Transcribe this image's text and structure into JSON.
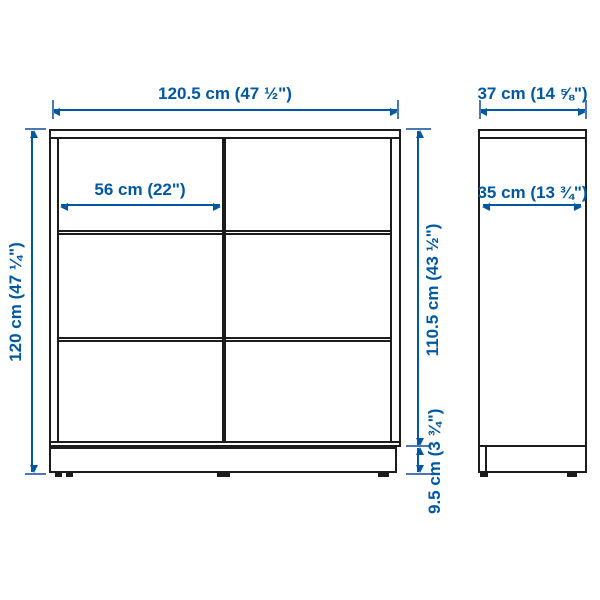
{
  "diagram_title": "Shelving unit dimension diagram",
  "colors": {
    "dimension_blue": "#0058a3",
    "tick_blue": "#4a78b5",
    "outline_dark": "#1c1c1c",
    "background": "#ffffff"
  },
  "front_view": {
    "width_label": "120.5 cm (47 ½\")",
    "inner_width_label": "56 cm (22\")",
    "height_label": "120 cm (47 ¼\")",
    "inner_height_label": "110.5 cm (43 ½\")",
    "base_height_label": "9.5 cm (3 ¾\")",
    "columns": 2,
    "rows": 3
  },
  "side_view": {
    "depth_label": "37 cm (14 ⅝\")",
    "inner_depth_label": "35 cm (13 ¾\")"
  }
}
